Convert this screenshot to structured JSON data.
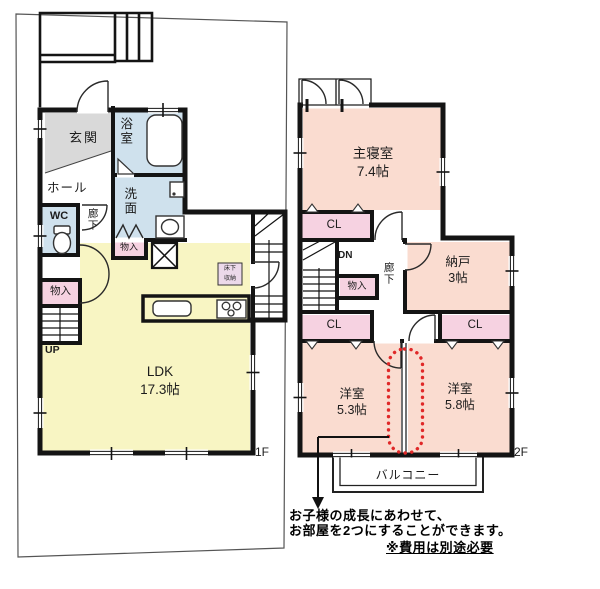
{
  "colors": {
    "wall": "#141414",
    "boundary": "#555555",
    "room_peach": "#fadcd0",
    "room_yellow": "#f8f5c3",
    "room_blue": "#cfe1ed",
    "closet_pink": "#f6d2e1",
    "genkan_gray": "#d9d9d9",
    "accent_red": "#e02828",
    "floor_storage_lavender": "#ecd9ea"
  },
  "floor1": {
    "floor_label": "1F",
    "rooms": {
      "genkan": "玄関",
      "hall": "ホール",
      "bath": "浴室",
      "wash": "洗面",
      "wc": "WC",
      "corridor": "廊下",
      "storage_top": "物入",
      "storage_left": "物入",
      "up": "UP",
      "ldk_name": "LDK",
      "ldk_size": "17.3帖",
      "floor_storage_l1": "床下",
      "floor_storage_l2": "収納"
    }
  },
  "floor2": {
    "floor_label": "2F",
    "rooms": {
      "master_name": "主寝室",
      "master_size": "7.4帖",
      "closet1": "CL",
      "closet2": "CL",
      "closet3": "CL",
      "dn": "DN",
      "corridor": "廊下",
      "storage": "物入",
      "nando_name": "納戸",
      "nando_size": "3帖",
      "west1_name": "洋室",
      "west1_size": "5.3帖",
      "west2_name": "洋室",
      "west2_size": "5.8帖",
      "balcony": "バルコニー"
    }
  },
  "annotation": {
    "line1": "お子様の成長にあわせて、",
    "line2": "お部屋を2つにすることができます。",
    "line3": "※費用は別途必要"
  }
}
